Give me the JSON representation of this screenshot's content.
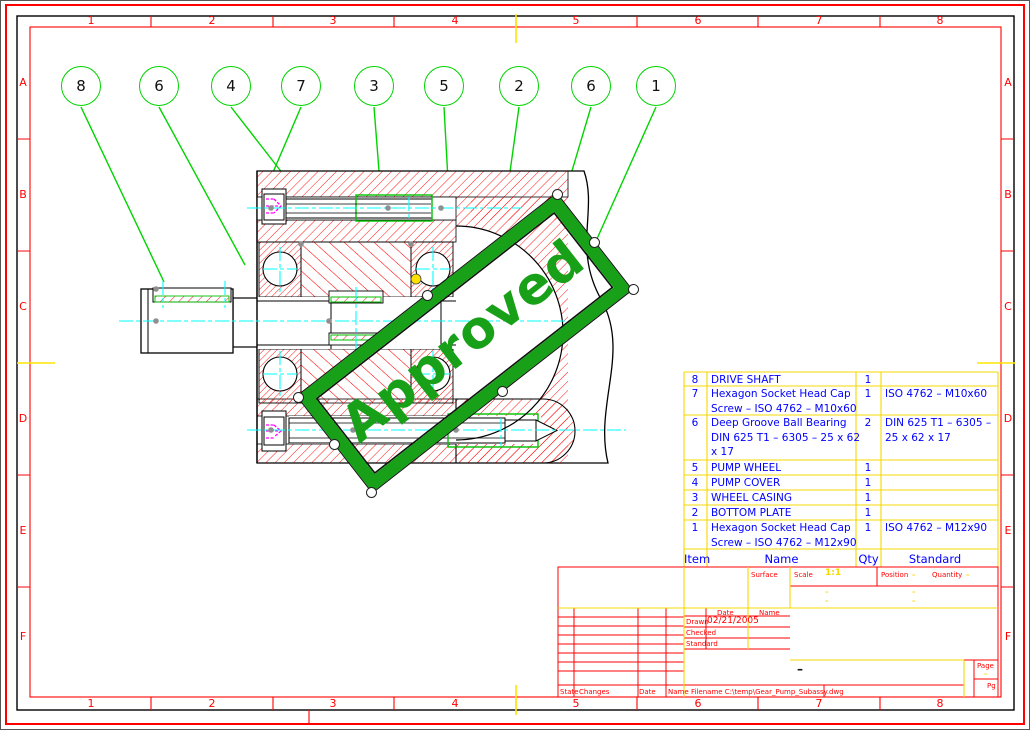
{
  "sheet": {
    "grid_cols": [
      "1",
      "2",
      "3",
      "4",
      "5",
      "6",
      "7",
      "8"
    ],
    "grid_rows": [
      "A",
      "B",
      "C",
      "D",
      "E",
      "F"
    ]
  },
  "balloons": [
    "8",
    "6",
    "4",
    "7",
    "3",
    "5",
    "2",
    "6",
    "1"
  ],
  "stamp": {
    "text": "Approved"
  },
  "parts_list": {
    "headers": {
      "item": "Item",
      "name": "Name",
      "qty": "Qty",
      "standard": "Standard"
    },
    "rows": [
      {
        "item": "8",
        "name": "DRIVE SHAFT",
        "qty": "1",
        "standard": ""
      },
      {
        "item": "7",
        "name": "Hexagon Socket Head Cap\nScrew – ISO 4762 – M10x60",
        "qty": "1",
        "standard": "ISO 4762 – M10x60"
      },
      {
        "item": "6",
        "name": "Deep Groove Ball Bearing\nDIN 625 T1 – 6305 – 25 x 62\nx 17",
        "qty": "2",
        "standard": "DIN 625 T1 – 6305 –\n25 x 62 x 17"
      },
      {
        "item": "5",
        "name": "PUMP WHEEL",
        "qty": "1",
        "standard": ""
      },
      {
        "item": "4",
        "name": "PUMP COVER",
        "qty": "1",
        "standard": ""
      },
      {
        "item": "3",
        "name": "WHEEL CASING",
        "qty": "1",
        "standard": ""
      },
      {
        "item": "2",
        "name": "BOTTOM PLATE",
        "qty": "1",
        "standard": ""
      },
      {
        "item": "1",
        "name": "Hexagon Socket Head Cap\nScrew – ISO 4762 – M12x90",
        "qty": "1",
        "standard": "ISO 4762 – M12x90"
      }
    ]
  },
  "title_block": {
    "surface_label": "Surface",
    "scale_label": "Scale",
    "scale_value": "1:1",
    "position_label": "Position",
    "position_value": "–",
    "quantity_label": "Quantity",
    "quantity_value": "–",
    "sub_value_a": "–",
    "sub_value_b": "–",
    "sub_value_c": "–",
    "sub_value_d": "–",
    "date_header": "Date",
    "name_header": "Name",
    "drawn_label": "Drawn",
    "drawn_date": "02/21/2005",
    "checked_label": "Checked",
    "standard_label": "Standard",
    "state_label": "State",
    "changes_label": "Changes",
    "date_label": "Date",
    "name_label": "Name",
    "filename": "Filename C:\\temp\\Gear_Pump_Subassy.dwg",
    "page_label": "Page",
    "page_value": "–",
    "pages_label": "Pg",
    "number_dash": "–"
  }
}
